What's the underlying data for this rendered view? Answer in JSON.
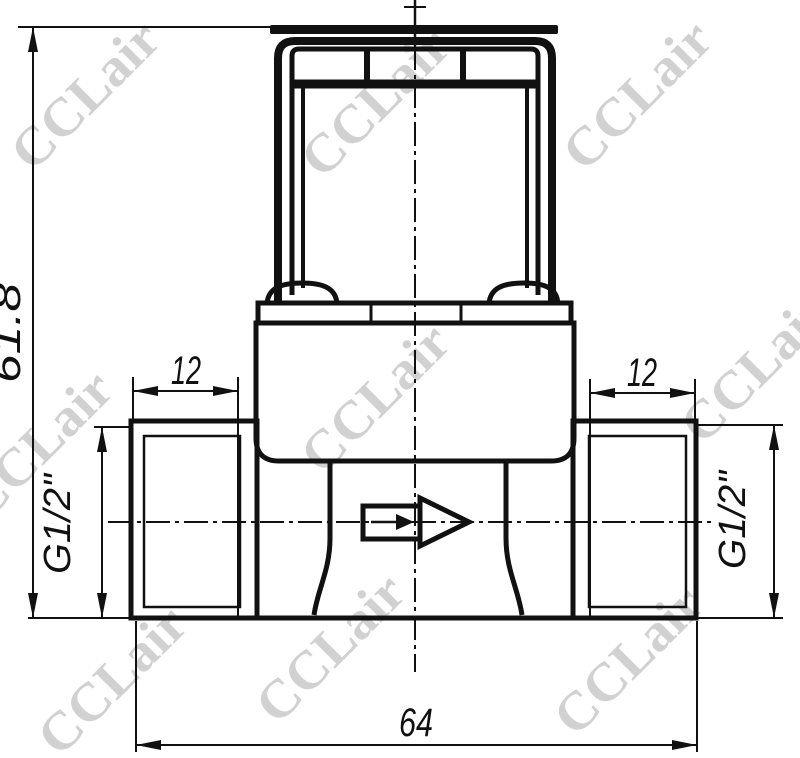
{
  "drawing": {
    "type": "technical-drawing",
    "view": "front view of solenoid valve with mounting bracket, threaded side ports and flow arrow",
    "background": "#ffffff",
    "line_color": "#111111",
    "flow_direction": "right",
    "dimensions": {
      "overall_height": "61.8",
      "overall_width": "64",
      "left_thread_length": "12",
      "right_thread_length": "12",
      "left_port_thread": "G1/2\"",
      "right_port_thread": "G1/2\""
    },
    "watermark": {
      "text": "CCLair",
      "color": "#c9c9c9"
    }
  }
}
